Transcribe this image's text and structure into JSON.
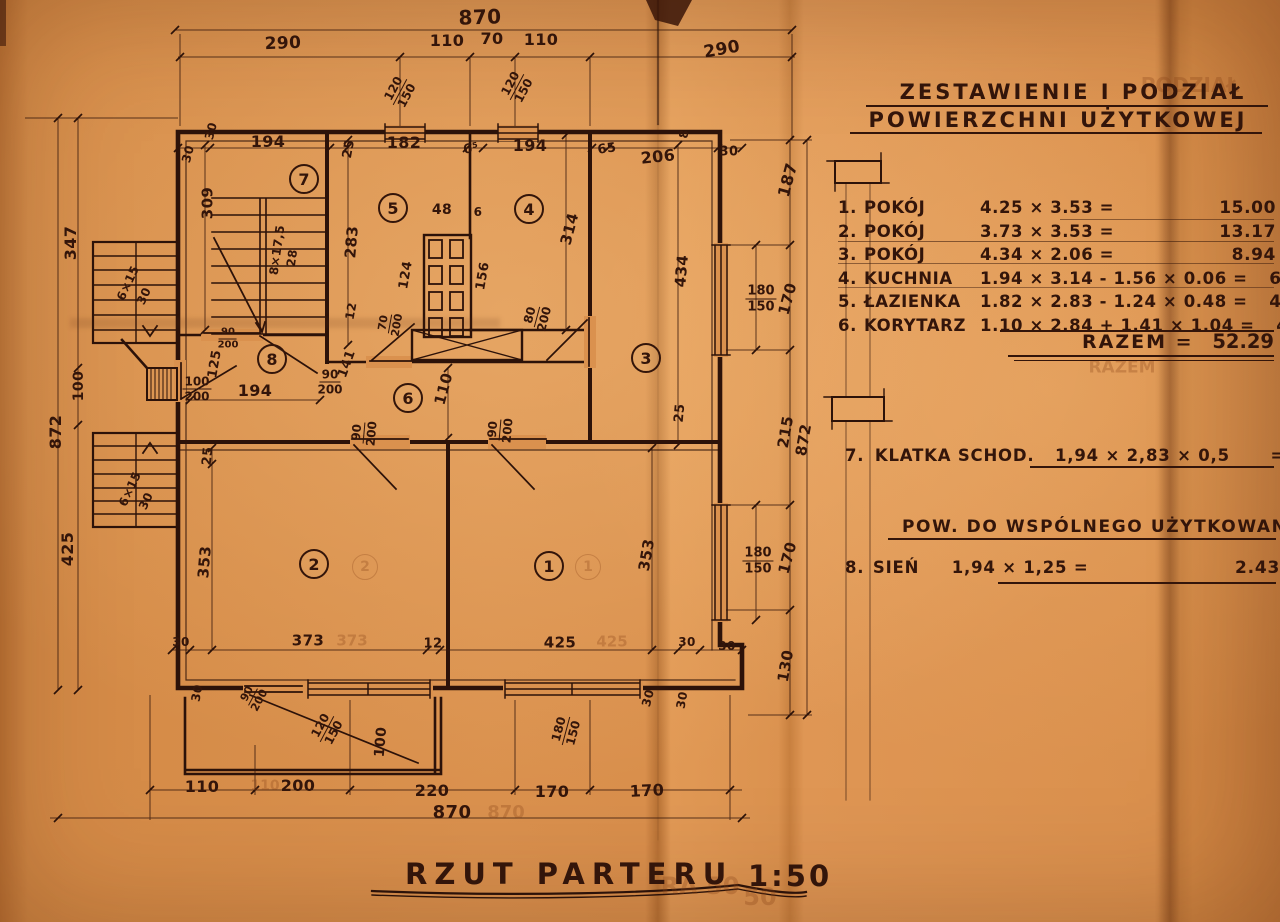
{
  "paper": {
    "bg_hex": "#d98f4c",
    "ink_hex": "#33150a"
  },
  "table": {
    "title_line1": "ZESTAWIENIE I PODZIAŁ",
    "title_line2": "POWIERZCHNI UŻYTKOWEJ",
    "rows": [
      {
        "num": "1.",
        "name": "POKÓJ",
        "formula": "4.25 × 3.53  =",
        "value": "15.00"
      },
      {
        "num": "2.",
        "name": "POKÓJ",
        "formula": "3.73 × 3.53  =",
        "value": "13.17"
      },
      {
        "num": "3.",
        "name": "POKÓJ",
        "formula": "4.34 × 2.06  =",
        "value": "8.94"
      },
      {
        "num": "4.",
        "name": "KUCHNIA",
        "formula": "1.94 × 3.14 - 1.56 × 0.06  =",
        "value": "6.00"
      },
      {
        "num": "5.",
        "name": "ŁAZIENKA",
        "formula": "1.82 × 2.83 - 1.24 × 0.48 =",
        "value": "4.59"
      },
      {
        "num": "6.",
        "name": "KORYTARZ",
        "formula": "1.10 × 2.84 + 1.41 × 1.04  =",
        "value": "4.59"
      }
    ],
    "total_label": "RAZEM =",
    "total_value": "52.29",
    "row7": {
      "num": "7.",
      "name": "KLATKA SCHOD.",
      "formula": "1,94 × 2,83 × 0,5",
      "equals": "=",
      "value": "2.75"
    },
    "section2_title": "POW. DO WSPÓLNEGO UŻYTKOWANIA",
    "row8": {
      "num": "8.",
      "name": "SIEŃ",
      "formula": "1,94 × 1,25 =",
      "value": "2.43"
    }
  },
  "footer": {
    "title": "RZUT  PARTERU",
    "scale": "1:50"
  },
  "plan": {
    "rooms": [
      {
        "n": "1",
        "x": 548,
        "y": 565
      },
      {
        "n": "2",
        "x": 313,
        "y": 563
      },
      {
        "n": "3",
        "x": 645,
        "y": 357
      },
      {
        "n": "4",
        "x": 528,
        "y": 208
      },
      {
        "n": "5",
        "x": 392,
        "y": 207
      },
      {
        "n": "6",
        "x": 407,
        "y": 397
      },
      {
        "n": "7",
        "x": 303,
        "y": 178
      },
      {
        "n": "8",
        "x": 271,
        "y": 358
      }
    ],
    "labels": [
      {
        "t": "870",
        "x": 480,
        "y": 17,
        "r": -2,
        "s": 20
      },
      {
        "t": "290",
        "x": 283,
        "y": 44,
        "r": -2,
        "s": 17
      },
      {
        "t": "110",
        "x": 447,
        "y": 41,
        "s": 16
      },
      {
        "t": "70",
        "x": 492,
        "y": 39,
        "s": 16
      },
      {
        "t": "110",
        "x": 541,
        "y": 40,
        "s": 16
      },
      {
        "t": "290",
        "x": 722,
        "y": 50,
        "r": -10,
        "s": 17
      },
      {
        "t": "120",
        "t2": "150",
        "x": 400,
        "y": 92,
        "r": -62,
        "s": 12
      },
      {
        "t": "120",
        "t2": "150",
        "x": 517,
        "y": 87,
        "r": -62,
        "s": 12
      },
      {
        "t": "30",
        "x": 188,
        "y": 154,
        "r": -75,
        "s": 12
      },
      {
        "t": "30",
        "x": 211,
        "y": 131,
        "r": -75,
        "s": 12
      },
      {
        "t": "194",
        "x": 268,
        "y": 142,
        "s": 16
      },
      {
        "t": "25",
        "x": 349,
        "y": 149,
        "r": -80,
        "s": 13
      },
      {
        "t": "182",
        "x": 404,
        "y": 143,
        "s": 16
      },
      {
        "t": "6⁵",
        "x": 471,
        "y": 149,
        "r": -10,
        "s": 13
      },
      {
        "t": "194",
        "x": 530,
        "y": 146,
        "s": 16
      },
      {
        "t": "65",
        "x": 607,
        "y": 149,
        "r": -8,
        "s": 13
      },
      {
        "t": "206",
        "x": 658,
        "y": 157,
        "r": -6,
        "s": 16
      },
      {
        "t": "8",
        "x": 684,
        "y": 134,
        "r": -80,
        "s": 12
      },
      {
        "t": "30",
        "x": 729,
        "y": 152,
        "s": 13
      },
      {
        "t": "187",
        "x": 788,
        "y": 180,
        "r": -75,
        "s": 16
      },
      {
        "t": "347",
        "x": 71,
        "y": 243,
        "r": -90,
        "s": 16
      },
      {
        "t": "100",
        "x": 79,
        "y": 386,
        "r": -90,
        "s": 14
      },
      {
        "t": "872",
        "x": 56,
        "y": 432,
        "r": -90,
        "s": 16
      },
      {
        "t": "425",
        "x": 68,
        "y": 549,
        "r": -90,
        "s": 16
      },
      {
        "t": "6×15",
        "x": 128,
        "y": 283,
        "r": -65,
        "s": 12
      },
      {
        "t": "30",
        "x": 144,
        "y": 296,
        "r": -65,
        "s": 12
      },
      {
        "t": "6×15",
        "x": 130,
        "y": 489,
        "r": -65,
        "s": 12
      },
      {
        "t": "30",
        "x": 146,
        "y": 501,
        "r": -65,
        "s": 12
      },
      {
        "t": "309",
        "x": 208,
        "y": 203,
        "r": -90,
        "s": 15
      },
      {
        "t": "8×17,5",
        "x": 277,
        "y": 250,
        "r": -82,
        "s": 12
      },
      {
        "t": "28",
        "x": 292,
        "y": 258,
        "r": -82,
        "s": 12
      },
      {
        "t": "283",
        "x": 352,
        "y": 242,
        "r": -85,
        "s": 15
      },
      {
        "t": "48",
        "x": 442,
        "y": 210,
        "s": 14
      },
      {
        "t": "6",
        "x": 478,
        "y": 212,
        "s": 12
      },
      {
        "t": "124",
        "x": 406,
        "y": 275,
        "r": -80,
        "s": 13
      },
      {
        "t": "156",
        "x": 483,
        "y": 276,
        "r": -80,
        "s": 13
      },
      {
        "t": "12",
        "x": 351,
        "y": 311,
        "r": -80,
        "s": 12
      },
      {
        "t": "314",
        "x": 570,
        "y": 229,
        "r": -75,
        "s": 15
      },
      {
        "t": "434",
        "x": 682,
        "y": 271,
        "r": -85,
        "s": 15
      },
      {
        "t": "70",
        "t2": "200",
        "x": 390,
        "y": 324,
        "r": -80,
        "s": 11
      },
      {
        "t": "80",
        "t2": "200",
        "x": 537,
        "y": 317,
        "r": -75,
        "s": 12
      },
      {
        "t": "90",
        "t2": "200",
        "x": 228,
        "y": 339,
        "s": 10
      },
      {
        "t": "100",
        "t2": "200",
        "x": 197,
        "y": 389,
        "s": 12
      },
      {
        "t": "125",
        "x": 215,
        "y": 364,
        "r": -80,
        "s": 13
      },
      {
        "t": "194",
        "x": 255,
        "y": 391,
        "s": 16
      },
      {
        "t": "90",
        "t2": "200",
        "x": 330,
        "y": 382,
        "s": 12
      },
      {
        "t": "141",
        "x": 347,
        "y": 364,
        "r": -70,
        "s": 13
      },
      {
        "t": "110",
        "x": 444,
        "y": 389,
        "r": -75,
        "s": 15
      },
      {
        "t": "90",
        "t2": "200",
        "x": 364,
        "y": 433,
        "r": -85,
        "s": 12
      },
      {
        "t": "90",
        "t2": "200",
        "x": 500,
        "y": 430,
        "r": -85,
        "s": 12
      },
      {
        "t": "180",
        "t2": "150",
        "x": 761,
        "y": 299,
        "s": 13
      },
      {
        "t": "170",
        "x": 788,
        "y": 299,
        "r": -75,
        "s": 15
      },
      {
        "t": "25",
        "x": 680,
        "y": 413,
        "r": -85,
        "s": 13
      },
      {
        "t": "215",
        "x": 786,
        "y": 432,
        "r": -80,
        "s": 15
      },
      {
        "t": "872",
        "x": 804,
        "y": 440,
        "r": -80,
        "s": 15
      },
      {
        "t": "25",
        "x": 208,
        "y": 456,
        "r": -85,
        "s": 13
      },
      {
        "t": "353",
        "x": 205,
        "y": 562,
        "r": -85,
        "s": 15
      },
      {
        "t": "353",
        "x": 647,
        "y": 555,
        "r": -80,
        "s": 15
      },
      {
        "t": "180",
        "t2": "150",
        "x": 758,
        "y": 561,
        "s": 13
      },
      {
        "t": "170",
        "x": 788,
        "y": 558,
        "r": -75,
        "s": 15
      },
      {
        "t": "30",
        "x": 181,
        "y": 642,
        "s": 12
      },
      {
        "t": "373",
        "x": 308,
        "y": 641,
        "s": 15
      },
      {
        "t": "12",
        "x": 433,
        "y": 644,
        "s": 13
      },
      {
        "t": "425",
        "x": 560,
        "y": 643,
        "s": 15
      },
      {
        "t": "30",
        "x": 687,
        "y": 642,
        "s": 12
      },
      {
        "t": "30",
        "x": 727,
        "y": 646,
        "s": 12
      },
      {
        "t": "130",
        "x": 786,
        "y": 666,
        "r": -80,
        "s": 15
      },
      {
        "t": "30",
        "x": 197,
        "y": 693,
        "r": -80,
        "s": 12
      },
      {
        "t": "90",
        "t2": "200",
        "x": 253,
        "y": 697,
        "r": -62,
        "s": 11
      },
      {
        "t": "120",
        "t2": "150",
        "x": 327,
        "y": 729,
        "r": -62,
        "s": 12
      },
      {
        "t": "100",
        "x": 381,
        "y": 742,
        "r": -85,
        "s": 14
      },
      {
        "t": "180",
        "t2": "150",
        "x": 566,
        "y": 731,
        "r": -75,
        "s": 12
      },
      {
        "t": "30",
        "x": 648,
        "y": 698,
        "r": -75,
        "s": 12
      },
      {
        "t": "30",
        "x": 682,
        "y": 700,
        "r": -80,
        "s": 12
      },
      {
        "t": "110",
        "x": 202,
        "y": 787,
        "s": 16
      },
      {
        "t": "200",
        "x": 298,
        "y": 786,
        "s": 16
      },
      {
        "t": "220",
        "x": 432,
        "y": 791,
        "s": 16
      },
      {
        "t": "170",
        "x": 552,
        "y": 792,
        "s": 16
      },
      {
        "t": "170",
        "x": 647,
        "y": 791,
        "r": -3,
        "s": 16
      },
      {
        "t": "870",
        "x": 452,
        "y": 813,
        "s": 18
      }
    ],
    "ghost_prints": [
      {
        "t": "373",
        "x": 352,
        "y": 641,
        "s": 15
      },
      {
        "t": "425",
        "x": 612,
        "y": 642,
        "s": 15
      },
      {
        "t": "870",
        "x": 506,
        "y": 813,
        "s": 18
      },
      {
        "t": "110",
        "x": 265,
        "y": 786,
        "s": 14
      },
      {
        "t": "RAZEM",
        "x": 1122,
        "y": 368,
        "s": 17
      },
      {
        "t": "PODZIAŁ",
        "x": 1190,
        "y": 85,
        "s": 20
      },
      {
        "t": "2",
        "x": 365,
        "y": 567,
        "s": 14,
        "c": 1
      },
      {
        "t": "1",
        "x": 588,
        "y": 567,
        "s": 14,
        "c": 1
      },
      {
        "t": "RA 50",
        "x": 700,
        "y": 886,
        "s": 24
      },
      {
        "t": "50",
        "x": 760,
        "y": 897,
        "s": 24
      }
    ]
  }
}
